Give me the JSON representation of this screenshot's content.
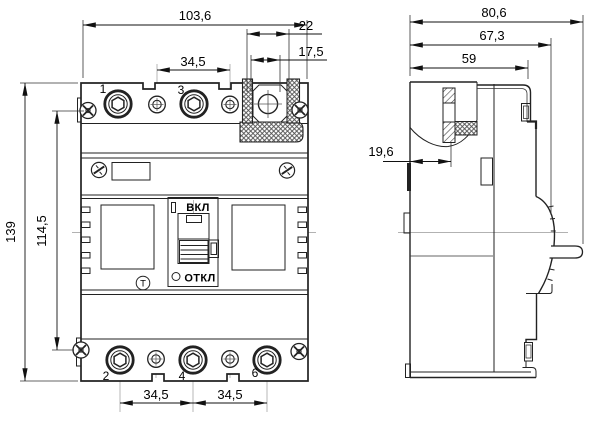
{
  "front_view": {
    "dimensions": {
      "overall_width": "103,6",
      "terminal_cover_width": "22",
      "terminal_cover_inner_width": "17,5",
      "top_pole_pitch": "34,5",
      "overall_height": "139",
      "mounting_hole_spacing": "114,5",
      "bottom_pole_pitch_left": "34,5",
      "bottom_pole_pitch_right": "34,5"
    },
    "terminal_numbers": {
      "top_left": "1",
      "top_middle": "3",
      "bottom_left": "2",
      "bottom_middle": "4",
      "bottom_right": "6"
    },
    "toggle": {
      "on_label": "ВКЛ",
      "off_label": "ОТКЛ"
    },
    "test_button_label": "Т"
  },
  "side_view": {
    "dimensions": {
      "overall_depth": "80,6",
      "depth_to_panel_face": "67,3",
      "body_depth": "59",
      "mounting_hole_offset": "19,6"
    }
  },
  "colors": {
    "line": "#222222",
    "dimension": "#111111",
    "background": "#ffffff"
  }
}
